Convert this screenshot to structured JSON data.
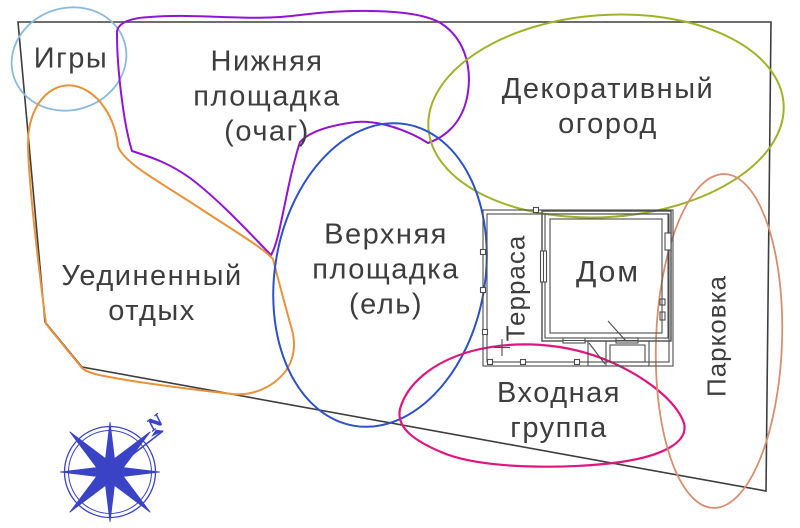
{
  "title": "Функциональное зонирование участка",
  "boundary": {
    "color": "#3e3e3e"
  },
  "text_color": "#3d3d3d",
  "zones": {
    "games": {
      "label": "Игры",
      "color": "#8abadf"
    },
    "lower_area": {
      "lines": [
        "Нижняя",
        "площадка",
        "(очаг)"
      ],
      "color": "#9114d4"
    },
    "decorative_garden": {
      "lines": [
        "Декоративный",
        "огород"
      ],
      "color": "#a0b229"
    },
    "secluded_rest": {
      "lines": [
        "Уединенный",
        "отдых"
      ],
      "color": "#e8923a"
    },
    "upper_area": {
      "lines": [
        "Верхняя",
        "площадка",
        "(ель)"
      ],
      "color": "#2d52c8"
    },
    "entrance_group": {
      "lines": [
        "Входная",
        "группа"
      ],
      "color": "#e0157d"
    },
    "parking": {
      "label": "Парковка",
      "color": "#d78f6f"
    }
  },
  "house": {
    "label": "Дом",
    "terrace_label": "Терраса",
    "line_color": "#4d4d4d"
  },
  "compass": {
    "north_label": "N",
    "color": "#3a43c5"
  }
}
